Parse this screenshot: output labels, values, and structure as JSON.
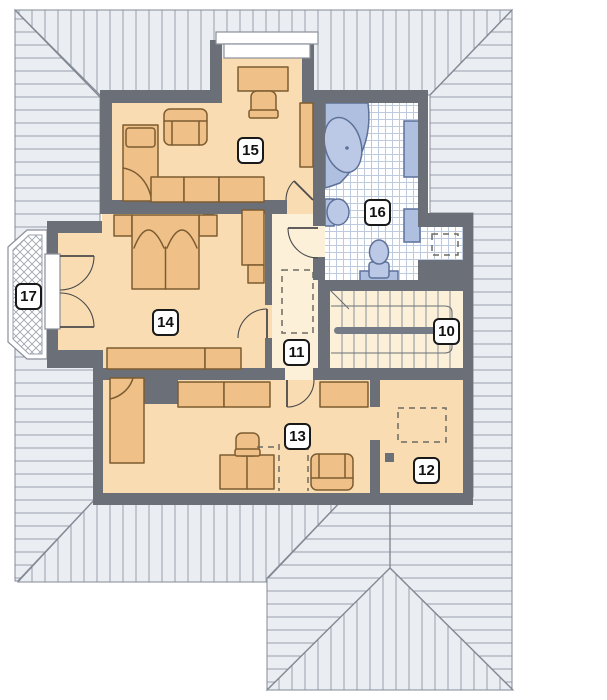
{
  "rooms": {
    "r10": {
      "label": "10"
    },
    "r11": {
      "label": "11"
    },
    "r12": {
      "label": "12"
    },
    "r13": {
      "label": "13"
    },
    "r14": {
      "label": "14"
    },
    "r15": {
      "label": "15"
    },
    "r16": {
      "label": "16"
    },
    "r17": {
      "label": "17"
    }
  },
  "colors": {
    "wall": "#6a6f78",
    "roof_fill": "#eaedf1",
    "roof_line": "#99a0aa",
    "roof_edge": "#838a95",
    "floor_room": "#f9dcb2",
    "floor_hall": "#fcf0d9",
    "furn": "#efc189",
    "furn_line": "#7d5c31",
    "fixture": "#aebfe0",
    "fixture_light": "#bcc9e6",
    "fixture_line": "#5d7199",
    "tile_line": "#becade",
    "balcony_line": "#9aa2ac",
    "dash": "#6d6a62",
    "white_line": "#8a8f99",
    "stair_line": "#8a8f99",
    "rail": "#767c87",
    "door": "#4a4a4a",
    "label_border": "#191919"
  }
}
